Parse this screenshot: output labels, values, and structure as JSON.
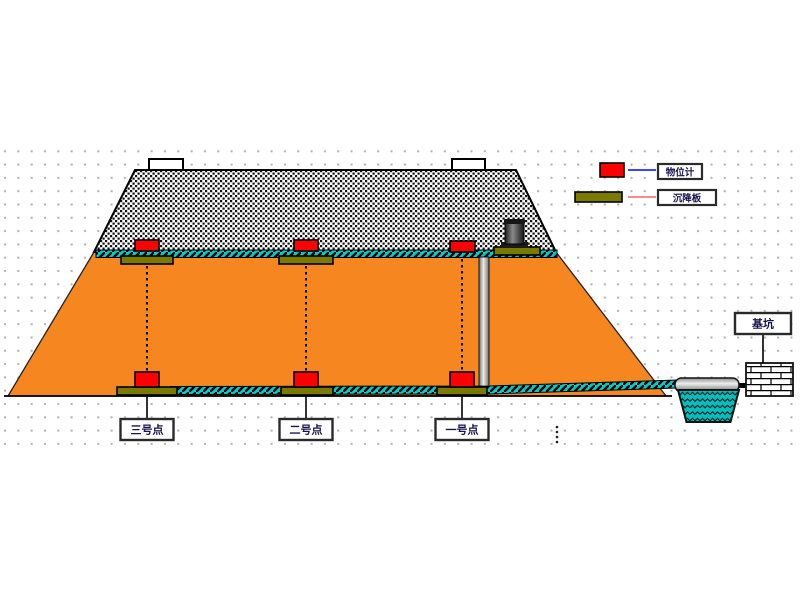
{
  "diagram_title": "dam-settlement-monitoring-section",
  "legend": {
    "items": [
      {
        "symbol": "level-gauge",
        "label": "物位计",
        "swatch_color": "#FF0000",
        "line_color": "#4444FF"
      },
      {
        "symbol": "settlement-plate",
        "label": "沉降板",
        "swatch_color": "#7A7A00",
        "line_color": "#FF8A8A"
      }
    ]
  },
  "points": [
    {
      "id": "point-3",
      "label": "三号点"
    },
    {
      "id": "point-2",
      "label": "二号点"
    },
    {
      "id": "point-1",
      "label": "一号点"
    }
  ],
  "structures": {
    "pit_label": "基坑"
  },
  "colors": {
    "embankment_fill": "#F6861F",
    "gauge_red": "#FF0000",
    "plate_olive": "#7A7A00",
    "conduit_cyan": "#00CDCD",
    "water_teal": "#00BFBF",
    "legend_line_blue": "#4444FF",
    "legend_line_pink": "#FF8A8A",
    "grid_dot": "#B0B0B0"
  }
}
